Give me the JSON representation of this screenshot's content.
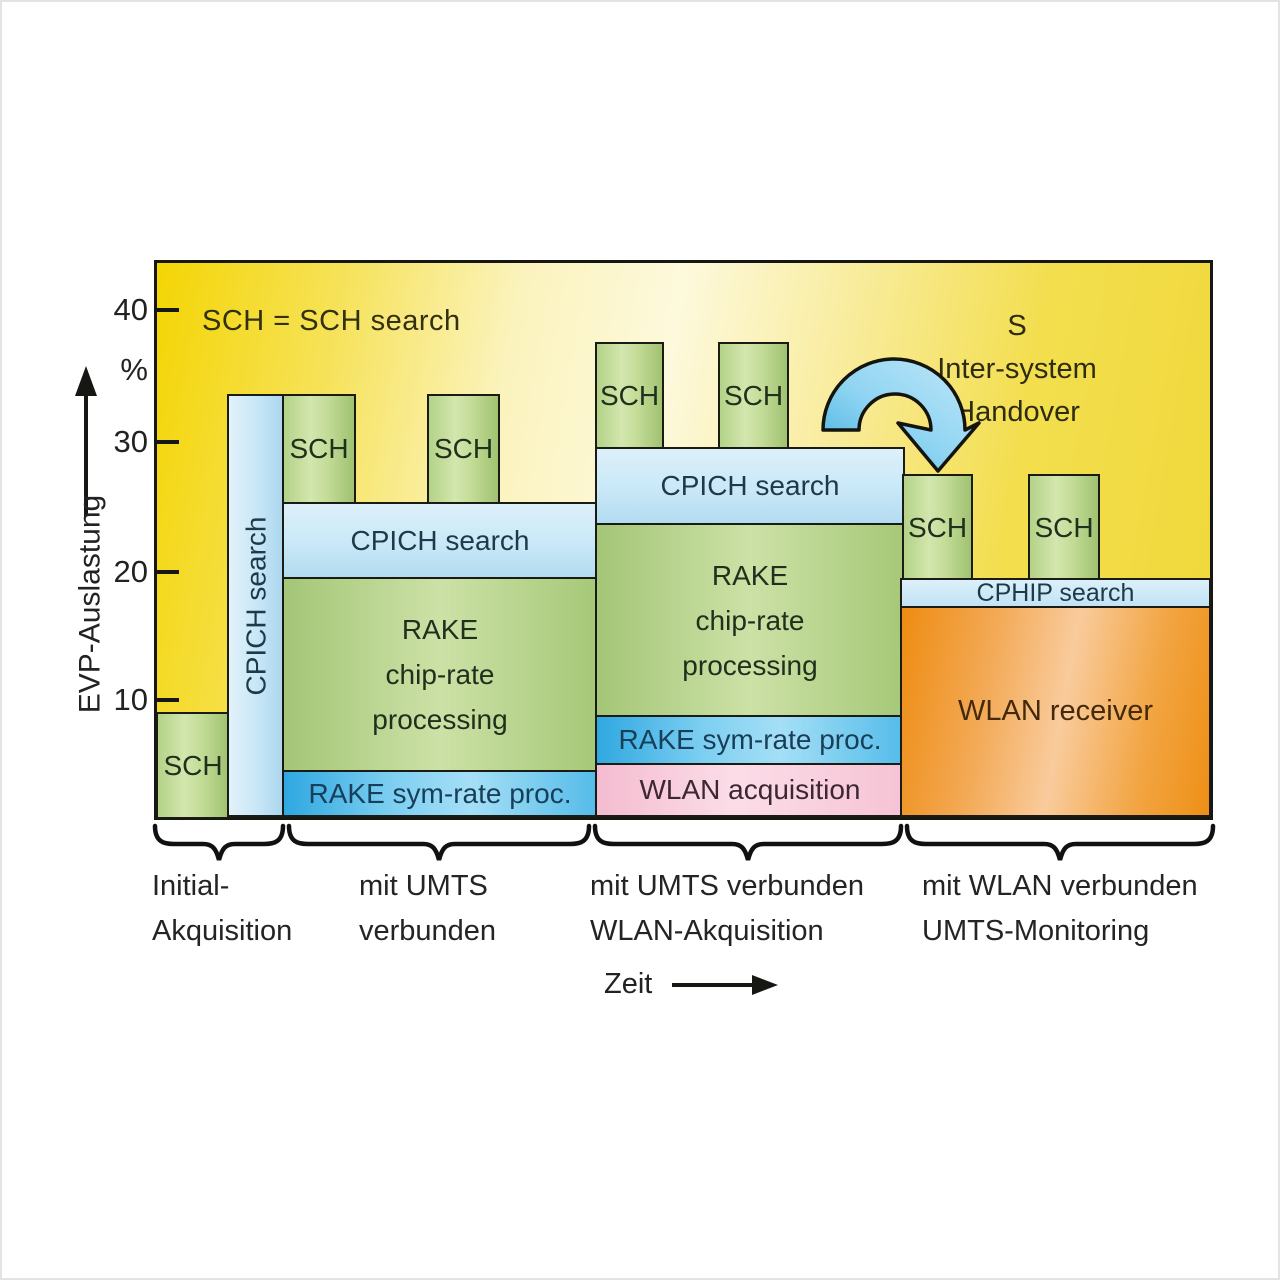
{
  "figure": {
    "legend": "SCH = SCH search",
    "handover": {
      "line1": "S",
      "line2": "Inter-system",
      "line3": "Handover"
    }
  },
  "y_axis": {
    "label": "EVP-Auslastung",
    "unit": "%",
    "ticks": [
      "40",
      "30",
      "20",
      "10"
    ]
  },
  "x_axis": {
    "label": "Zeit"
  },
  "blocks": {
    "sch": "SCH",
    "cpich_search": "CPICH search",
    "rake_lines": [
      "RAKE",
      "chip-rate",
      "processing"
    ],
    "rake_sym": "RAKE sym-rate proc.",
    "wlan_acquisition": "WLAN acquisition",
    "wlan_receiver": "WLAN receiver",
    "cphip_search": "CPHIP search"
  },
  "phases": [
    {
      "line1": "Initial-",
      "line2": "Akquisition"
    },
    {
      "line1": "mit UMTS",
      "line2": "verbunden"
    },
    {
      "line1": "mit UMTS verbunden",
      "line2": "WLAN-Akquisition"
    },
    {
      "line1": "mit WLAN verbunden",
      "line2": "UMTS-Monitoring"
    }
  ],
  "colors": {
    "background_yellow": "#f2d60a",
    "background_pale": "#fcf7d2",
    "sch_green": "#bcd795",
    "cpich_blue": "#c8e6f5",
    "rake_green": "#b7d48c",
    "symrate_cyan": "#56bce8",
    "wlan_acq_pink": "#f6c5d6",
    "wlan_rx_orange": "#f19c33",
    "arrow_blue": "#7fccee"
  }
}
